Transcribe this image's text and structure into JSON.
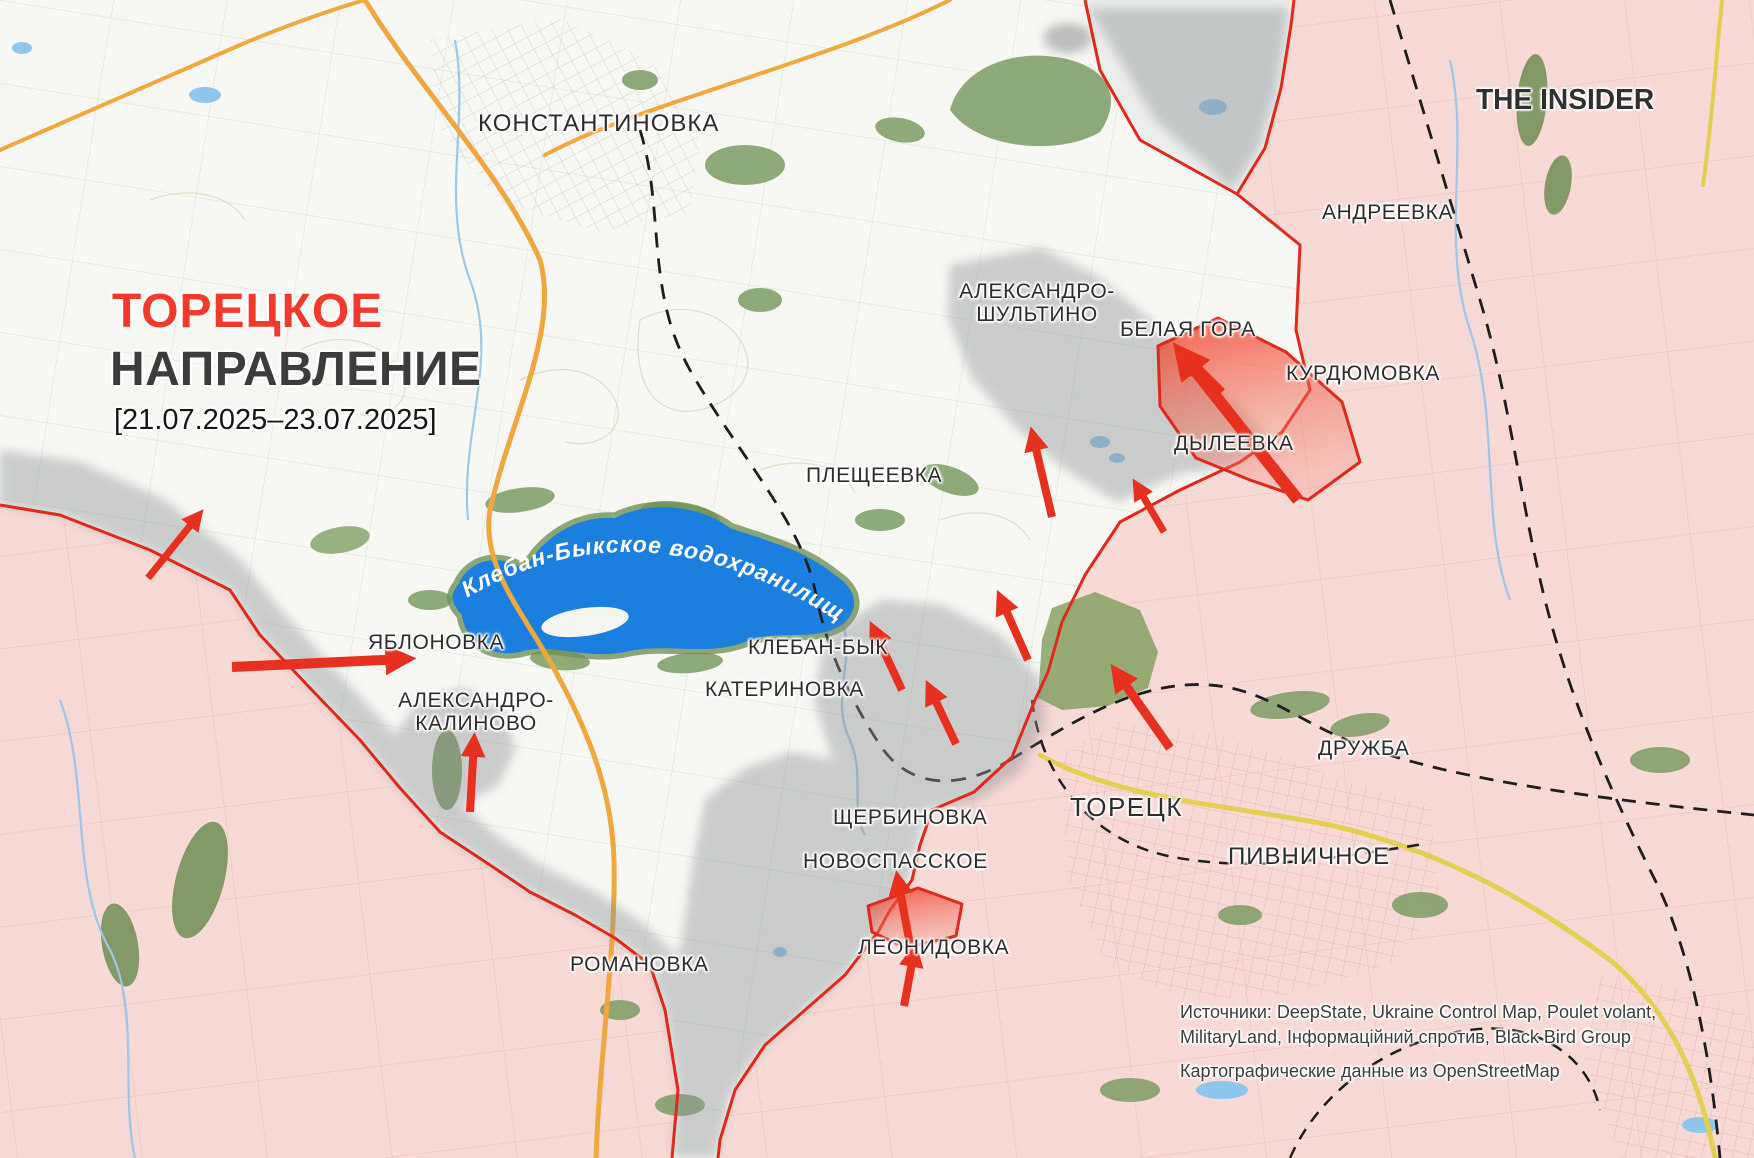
{
  "title": {
    "line1": "ТОРЕЦКОЕ",
    "line2": "НАПРАВЛЕНИЕ",
    "date_range": "[21.07.2025–23.07.2025]"
  },
  "branding": {
    "logo": "THE INSIDER"
  },
  "water": {
    "reservoir_label": "Клебан-Быкское водохранилище"
  },
  "cities": [
    {
      "id": "konstantinovka",
      "name": "КОНСТАНТИНОВКА"
    },
    {
      "id": "andreevka",
      "name": "АНДРЕЕВКА"
    },
    {
      "id": "aleksandro-shultino",
      "name": "АЛЕКСАНДРО-ШУЛЬТИНО"
    },
    {
      "id": "belaya-gora",
      "name": "БЕЛАЯ ГОРА"
    },
    {
      "id": "kurdyumovka",
      "name": "КУРДЮМОВКА"
    },
    {
      "id": "dyleevka",
      "name": "ДЫЛЕЕВКА"
    },
    {
      "id": "plescheevka",
      "name": "ПЛЕЩЕЕВКА"
    },
    {
      "id": "yablonovka",
      "name": "ЯБЛОНОВКА"
    },
    {
      "id": "aleksandro-kalinovo",
      "name": "АЛЕКСАНДРО-КАЛИНОВО"
    },
    {
      "id": "kleban-byk",
      "name": "КЛЕБАН-БЫК"
    },
    {
      "id": "katerinovka",
      "name": "КАТЕРИНОВКА"
    },
    {
      "id": "scherbinovka",
      "name": "ЩЕРБИНОВКА"
    },
    {
      "id": "novospasskoe",
      "name": "НОВОСПАССКОЕ"
    },
    {
      "id": "leonidovka",
      "name": "ЛЕОНИДОВКА"
    },
    {
      "id": "romanovka",
      "name": "РОМАНОВКА"
    },
    {
      "id": "toretsk",
      "name": "ТОРЕЦК"
    },
    {
      "id": "pivnichnoe",
      "name": "ПИВНИЧНОЕ"
    },
    {
      "id": "druzhba",
      "name": "ДРУЖБА"
    }
  ],
  "sources": {
    "line1": "Источники: DeepState, Ukraine Control Map, Poulet volant,",
    "line2": "MilitaryLand, Інформаційний спротив, Black Bird Group",
    "line3": "Картографические данные из OpenStreetMap"
  },
  "colors": {
    "occupied_fill": "#f7d9d6",
    "contested_fill": "#8f9496",
    "advance_fill": "#f04f35",
    "frontline": "#e0281c",
    "arrow": "#e8301f",
    "water": "#1b7fe0",
    "forest": "#7d9c62",
    "road_major": "#f0a73e",
    "road_secondary": "#e3cf52",
    "title_accent": "#f3392c"
  }
}
